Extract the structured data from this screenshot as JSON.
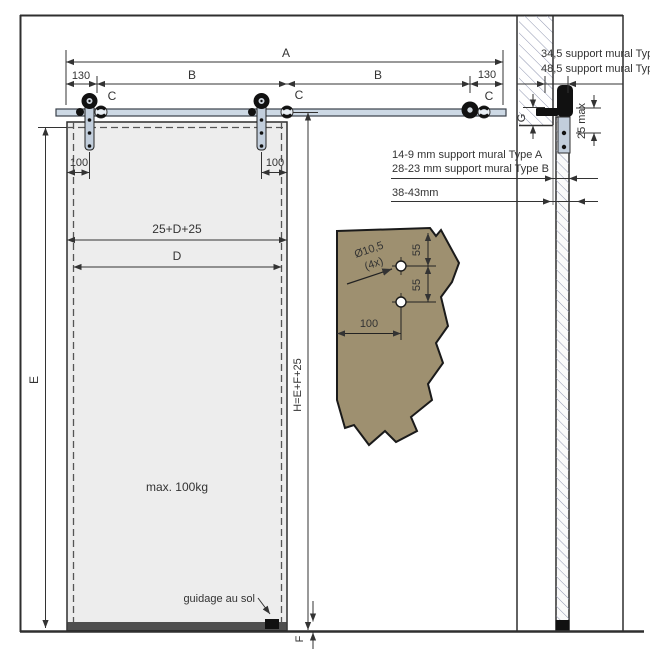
{
  "dims_top": {
    "overall": "A",
    "left_offset": "130",
    "span_left": "B",
    "span_right": "B",
    "right_offset": "130"
  },
  "hangers": {
    "c1": "C",
    "c2": "C",
    "c3": "C"
  },
  "door": {
    "hanger_offset_left": "100",
    "hanger_offset_right": "100",
    "total_width": "25+D+25",
    "width": "D",
    "height": "E",
    "system_height": "H=E+F+25",
    "floor_gap": "F",
    "max_weight": "max. 100kg",
    "floor_guide_label": "guidage au sol"
  },
  "section": {
    "support_a": "34,5 support mural Type A",
    "support_b": "48,5 support mural Type B",
    "wall_gap_a": "14-9 mm support mural Type A",
    "wall_gap_b": "28-23 mm support mural Type B",
    "total_thickness": "38-43mm",
    "lintel_gap": "G",
    "top_clearance": "25 max"
  },
  "detail": {
    "hole_diameter": "Ø10,5",
    "hole_count": "(4x)",
    "hole_spacing_top": "55",
    "hole_spacing_bottom": "55",
    "edge_distance": "100"
  },
  "colors": {
    "line": "#2f2f2f",
    "dim": "#333333",
    "rail_fill": "#cdd9e5",
    "strap_fill": "#c2cedc",
    "door_fill": "#ededed",
    "door_edge": "#4f4f4f",
    "hatch": "#9096b0",
    "fragment_fill": "#9e9070",
    "hardware": "#111111"
  }
}
